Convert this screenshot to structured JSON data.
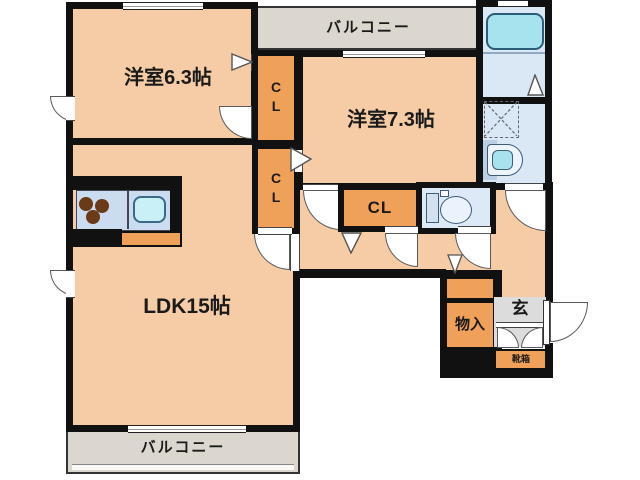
{
  "plan": {
    "rooms": {
      "western_6_3": {
        "label": "洋室6.3帖"
      },
      "western_7_3": {
        "label": "洋室7.3帖"
      },
      "ldk": {
        "label": "LDK15帖"
      },
      "closet_a": {
        "label": "CL"
      },
      "closet_b": {
        "label": "CL"
      },
      "closet_c": {
        "label": "CL"
      },
      "storage": {
        "label": "物入"
      },
      "entrance": {
        "label": "玄"
      },
      "shoe_cabinet": {
        "label": "靴箱"
      },
      "balcony_north": {
        "label": "バルコニー"
      },
      "balcony_south": {
        "label": "バルコニー"
      }
    },
    "fixtures": {
      "bathtub": "bathtub-icon",
      "toilet": "toilet-icon",
      "washbasin": "washbasin-icon",
      "washing_machine_pan": "washing-machine-pan-icon",
      "stove_burners": "stove-burners-icon",
      "kitchen_sink": "kitchen-sink-icon"
    },
    "colors": {
      "wall": "#111111",
      "room_fill": "#f5cca6",
      "closet_fill": "#f0a159",
      "balcony_fill": "#dbd7cf",
      "entrance_fill": "#dcdcdc",
      "wet_area_fill": "#d9e8f4",
      "tub_fill": "#a6e3ee",
      "background": "#ffffff"
    }
  }
}
